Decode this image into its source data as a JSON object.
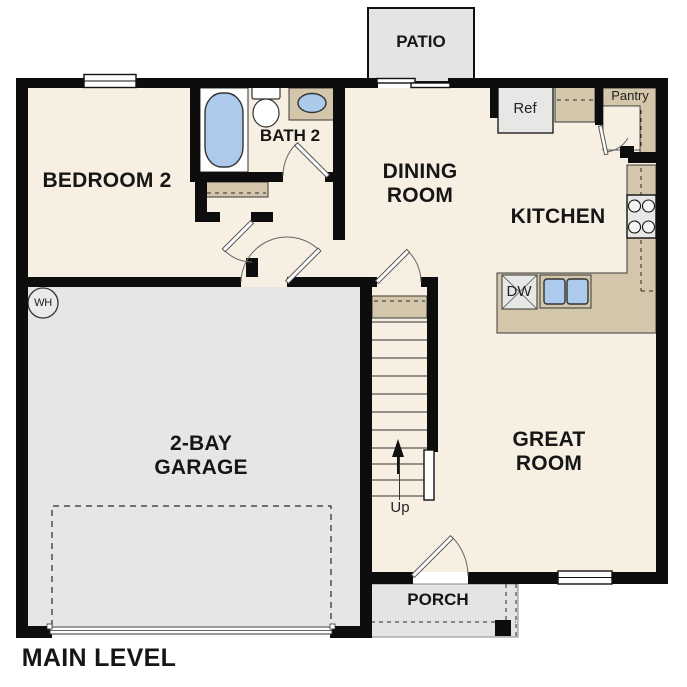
{
  "plan_title": "MAIN LEVEL",
  "areas": {
    "bedroom2": {
      "label": "BEDROOM 2"
    },
    "bath2": {
      "label": "BATH 2"
    },
    "dining_room": {
      "label": "DINING\nROOM"
    },
    "kitchen": {
      "label": "KITCHEN"
    },
    "pantry": {
      "label": "Pantry"
    },
    "great_room": {
      "label": "GREAT\nROOM"
    },
    "garage": {
      "label": "2-BAY\nGARAGE"
    },
    "patio": {
      "label": "PATIO"
    },
    "porch": {
      "label": "PORCH"
    },
    "stairs": {
      "direction_label": "Up"
    }
  },
  "fixtures": {
    "refrigerator": "Ref",
    "dishwasher": "DW",
    "water_heater": "WH"
  },
  "palette": {
    "floor": "#f7efe2",
    "garage_floor": "#e6e6e4",
    "counter": "#d3c6ab",
    "plumbing_blue": "#abcaec",
    "wall": "#0d0d0d",
    "background": "#ffffff"
  }
}
